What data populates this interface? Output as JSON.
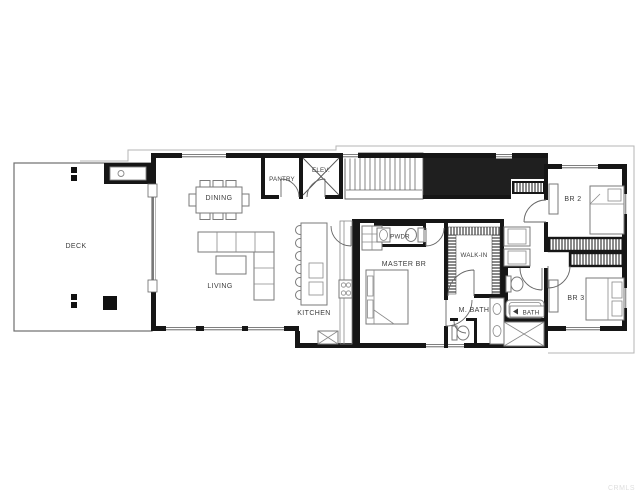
{
  "title": "Upper level floor plan",
  "watermark": "CRMLS",
  "rooms": {
    "deck": {
      "label": "DECK"
    },
    "dining": {
      "label": "DINING"
    },
    "living": {
      "label": "LIVING"
    },
    "pantry": {
      "label": "PANTRY"
    },
    "elevator": {
      "label": "ELEV."
    },
    "kitchen": {
      "label": "KITCHEN"
    },
    "powder": {
      "label": "PWDR"
    },
    "master_bedroom": {
      "label": "MASTER BR"
    },
    "walk_in": {
      "label": "WALK-IN"
    },
    "master_bath": {
      "label": "M. BATH"
    },
    "bath": {
      "label": "BATH"
    },
    "bedroom2": {
      "label": "BR 2"
    },
    "bedroom3": {
      "label": "BR 3"
    }
  },
  "colors": {
    "wall": "#161616",
    "black_fill": "#1f1f1f",
    "furniture_line": "#7a7a7a",
    "label": "#3c3c3c",
    "background": "#ffffff",
    "watermark": "#dedede"
  }
}
